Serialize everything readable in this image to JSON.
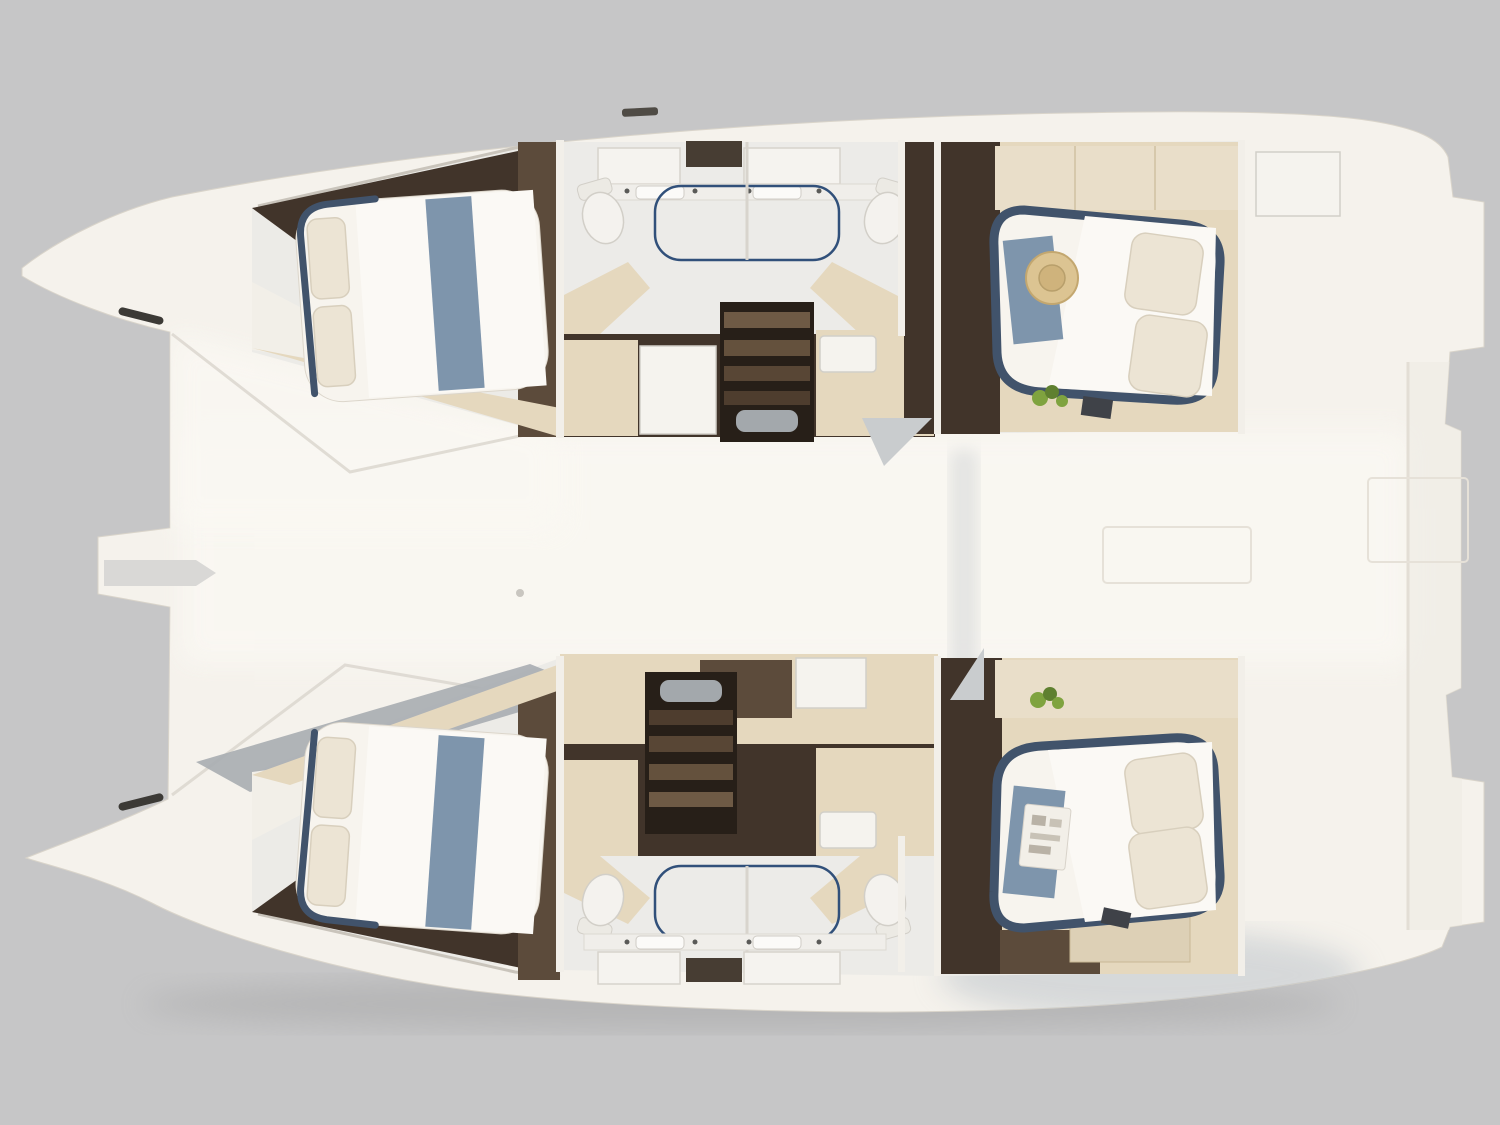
{
  "meta": {
    "title": "Catamaran interior floor plan — top-down cutaway rendering",
    "view": "top-down",
    "background": "studio gray",
    "vessel_type": "catamaran",
    "layout": "4 cabins / 2 bathrooms"
  },
  "scene": {
    "hulls": [
      {
        "name": "port-hull",
        "position": "top",
        "rooms": [
          "forward-cabin",
          "bathroom",
          "companionway-stairs",
          "aft-cabin"
        ],
        "bathroom": {
          "toilets": 2,
          "sinks": 2,
          "mirror-cabinets": 2,
          "shower": 1
        },
        "props": [
          "blue-runner",
          "pillows",
          "straw-hat",
          "plant",
          "stair-mat",
          "bow-cleat"
        ]
      },
      {
        "name": "starboard-hull",
        "position": "bottom",
        "rooms": [
          "forward-cabin",
          "bathroom",
          "companionway-stairs",
          "aft-cabin"
        ],
        "bathroom": {
          "toilets": 2,
          "sinks": 2,
          "mirror-cabinets": 2,
          "shower": 1
        },
        "props": [
          "blue-runner",
          "pillows",
          "magazine",
          "plant",
          "stair-mat",
          "bow-cleat"
        ]
      }
    ],
    "bridgedeck": {
      "name": "center-deck",
      "features": [
        "anchor-slot",
        "deck-hatches",
        "transom-steps"
      ]
    },
    "counts": {
      "beds": 4,
      "toilets": 4,
      "showers": 2,
      "staircases": 2,
      "plants": 2
    }
  },
  "palette": {
    "bg": "#c6c6c7",
    "hull": "#f5f2ec",
    "hull-bright": "#faf8f3",
    "hull-edge": "#d9d4ca",
    "rim-line": "#ddd8d0",
    "wall-white": "#f2efe9",
    "floor-light": "#ecebe7",
    "wood-dark": "#41342a",
    "wood-mid": "#5c4b3b",
    "stairwell": "#271f18",
    "tread1": "#6e5a45",
    "tread2": "#64513d",
    "tread3": "#584635",
    "tread4": "#4e3d2e",
    "beige": "#e5d8be",
    "beige-dark": "#cdbd9e",
    "white-box": "#f5f3ee",
    "bed-white": "#f7f4ee",
    "duvet-bright": "#fbf9f5",
    "pillow": "#ece4d4",
    "navy": "#41536b",
    "runner": "#7e95ac",
    "glass": "#31507a",
    "toilet": "#f4f2ee",
    "fixture-line": "#d2cfc8",
    "mat": "#a3a8ac",
    "hat": "#dcc492",
    "hat-dark": "#c3a76f",
    "plant": "#7fa33f",
    "plant-dark": "#5f8030",
    "dark-item": "#3f4248",
    "cleat": "#3c3a36",
    "paper": "#f2efe8",
    "wedge-gray": "#a9adb1",
    "soft-shadow": "#b7bfc7"
  }
}
